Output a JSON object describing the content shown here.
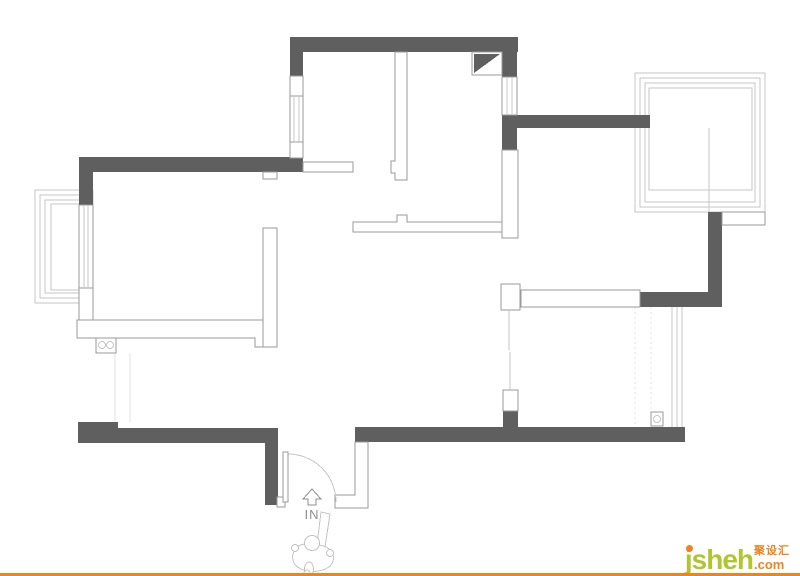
{
  "plan": {
    "type": "floor-plan",
    "description": "apartment floor plan line drawing",
    "symbols": [
      "entry-door-arc",
      "direction-arrow",
      "person-figure",
      "stove-two-burners",
      "flue-duct",
      "floor-drain",
      "windows",
      "balconies"
    ]
  },
  "entrance": {
    "label": "IN",
    "arrow_icon": "up-arrow"
  },
  "branding": {
    "logo_text": "jsheh",
    "logo_suffix": ".com",
    "logo_cjk": "聚设汇"
  },
  "colors": {
    "wall_fill": "#5f5f5f",
    "wall_outline": "#9a9a9a",
    "thin_line": "#c6c6c6",
    "faint_line": "#e0e0e0",
    "brand_orange": "#f0831e",
    "brand_green": "#b2c431",
    "label_gray": "#8f8f8f"
  }
}
